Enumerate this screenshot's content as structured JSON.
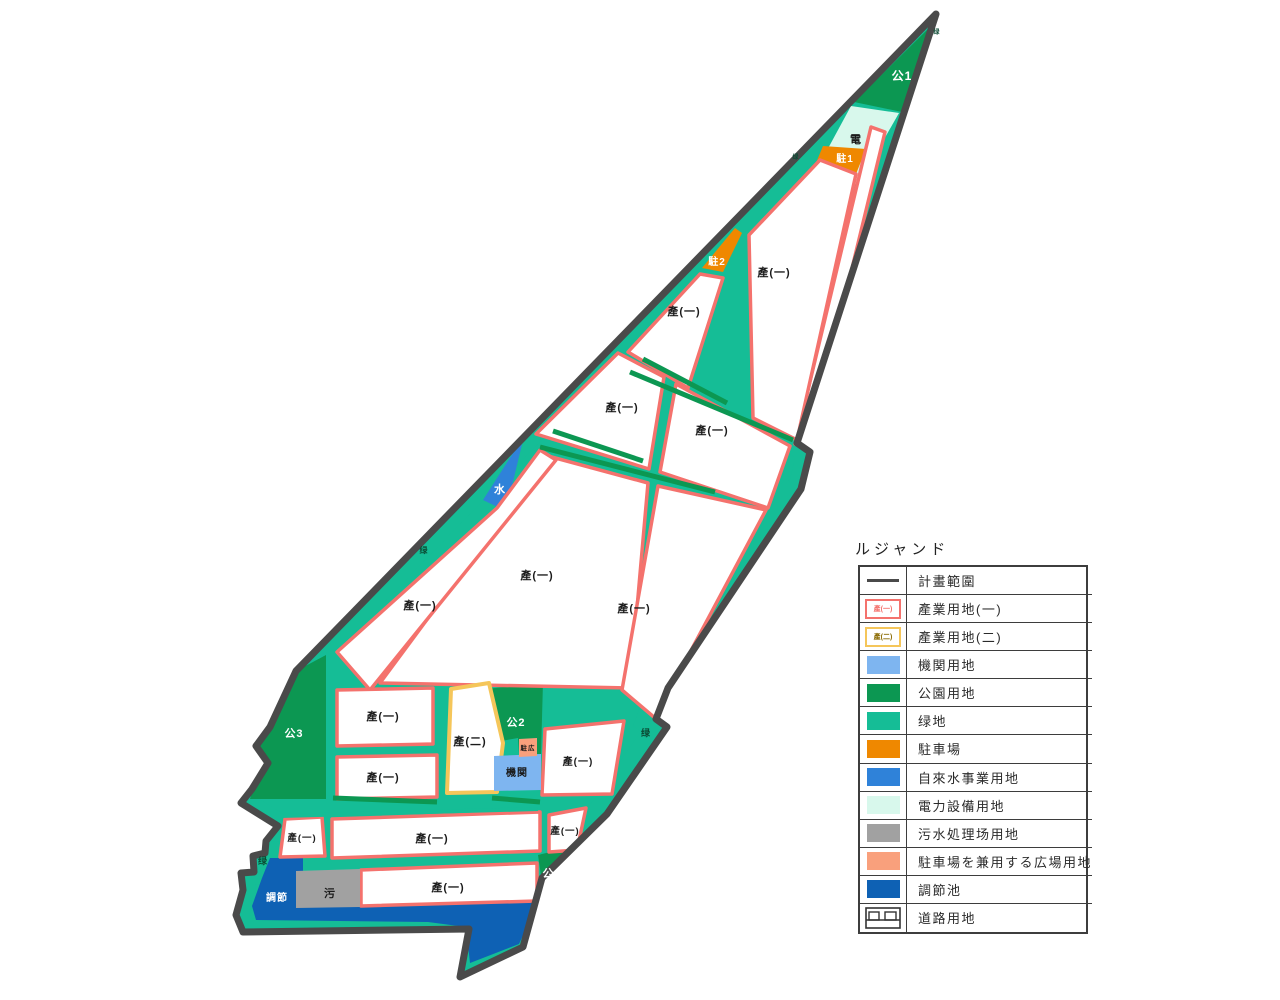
{
  "palette": {
    "boundary": "#4a4a4a",
    "greenbelt": "#15bd96",
    "park": "#0c9752",
    "parcel1_stroke": "#f4726d",
    "parcel2_stroke": "#f5c65a",
    "parcel2_text": "#8a6a00",
    "institution": "#7eb5f0",
    "parking": "#ef8800",
    "water_utility": "#2f82d9",
    "power": "#d8f8ec",
    "sewage": "#a1a1a1",
    "plaza": "#f9a07c",
    "pond": "#0e61b4",
    "parcel_fill": "#ffffff"
  },
  "legend": {
    "title": "ルジャンド",
    "rows": [
      {
        "label": "計畫範圍",
        "swatch": "line"
      },
      {
        "label": "產業用地(一)",
        "swatch": "outline-red",
        "swatch_text": "產(一)"
      },
      {
        "label": "產業用地(二)",
        "swatch": "outline-yellow",
        "swatch_text": "產(二)"
      },
      {
        "label": "機関用地",
        "swatch": "fill"
      },
      {
        "label": "公園用地",
        "swatch": "fill"
      },
      {
        "label": "绿地",
        "swatch": "fill"
      },
      {
        "label": "駐車場",
        "swatch": "fill"
      },
      {
        "label": "自來水事業用地",
        "swatch": "fill"
      },
      {
        "label": "電力設備用地",
        "swatch": "fill"
      },
      {
        "label": "污水処理场用地",
        "swatch": "fill"
      },
      {
        "label": "駐車場を兼用する広場用地",
        "swatch": "fill"
      },
      {
        "label": "調節池",
        "swatch": "fill"
      },
      {
        "label": "道路用地",
        "swatch": "road"
      }
    ]
  },
  "map": {
    "labels": [
      {
        "text": "公1"
      },
      {
        "text": "绿"
      },
      {
        "text": "電"
      },
      {
        "text": "駐1"
      },
      {
        "text": "绿"
      },
      {
        "text": "駐2"
      },
      {
        "text": "產(一)"
      },
      {
        "text": "產(一)"
      },
      {
        "text": "產(一)"
      },
      {
        "text": "產(一)"
      },
      {
        "text": "水"
      },
      {
        "text": "绿"
      },
      {
        "text": "產(一)"
      },
      {
        "text": "產(一)"
      },
      {
        "text": "產(一)"
      },
      {
        "text": "公3"
      },
      {
        "text": "產(一)"
      },
      {
        "text": "產(一)"
      },
      {
        "text": "產(二)"
      },
      {
        "text": "公2"
      },
      {
        "text": "駐広"
      },
      {
        "text": "機関"
      },
      {
        "text": "產(一)"
      },
      {
        "text": "绿"
      },
      {
        "text": "產(一)"
      },
      {
        "text": "產(一)"
      },
      {
        "text": "產(一)"
      },
      {
        "text": "绿"
      },
      {
        "text": "調節"
      },
      {
        "text": "污"
      },
      {
        "text": "產(一)"
      },
      {
        "text": "公4"
      }
    ]
  }
}
